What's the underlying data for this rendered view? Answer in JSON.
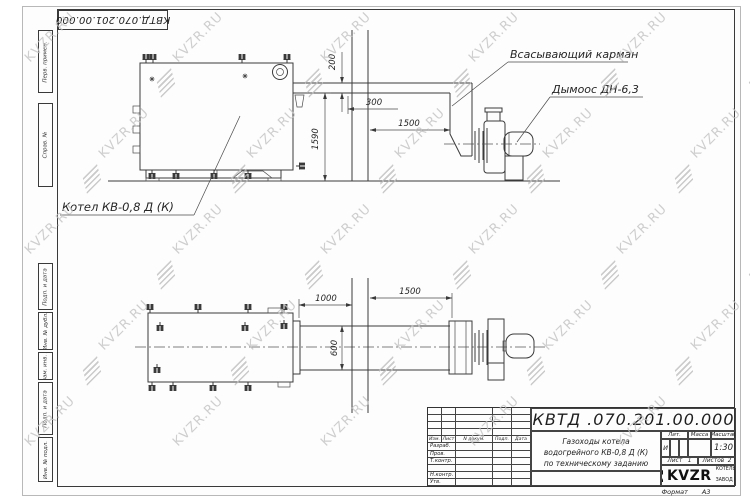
{
  "corner_stamp": "КВТД.070.201.00.000",
  "watermark": {
    "text": "KVZR.RU"
  },
  "margin": {
    "cells": [
      "Перв. примен.",
      "Справ. №",
      "Подп. и дата",
      "Инв. № дубл.",
      "Взам. инв. №",
      "Подп. и дата",
      "Инв. № подл."
    ]
  },
  "drawing": {
    "boiler_label": "Котел КВ-0,8 Д  (К)",
    "annotation_suction": "Всасывающий карман",
    "annotation_fan": "Дымоос ДН-6,3",
    "top_view_dims": {
      "duct_height": "200",
      "wall_offset": "300",
      "fan_distance": "1500",
      "outlet_height": "1590"
    },
    "plan_view_dims": {
      "boiler_to_wall": "1000",
      "wall_to_fan": "1500",
      "duct_width": "600"
    }
  },
  "title_block": {
    "doc_number": "КВТД .070.201.00.000",
    "description": "Газоходы котела водогрейного КВ-0,8 Д (К) по техническому заданию",
    "header_cells": [
      "Изм.",
      "Лист",
      "N докум.",
      "Подп.",
      "Дата"
    ],
    "row_labels": [
      "Разраб.",
      "Пров.",
      "Т.контр.",
      "",
      "Н.контр.",
      "Утв."
    ],
    "lit_label": "Лит.",
    "lit_value": "И",
    "mass_label": "Масса",
    "scale_label": "Масштаб",
    "scale_value": "1:30",
    "sheet_label": "Лист",
    "sheet_value": "1",
    "sheets_label": "Листов",
    "sheets_value": "2",
    "company_logo": "KVZR",
    "company_name_line1": "КОТЕЛЬНЫЙ",
    "company_name_line2": "ЗАВОД РЭП",
    "format_label": "Формат",
    "format_value": "А3"
  }
}
